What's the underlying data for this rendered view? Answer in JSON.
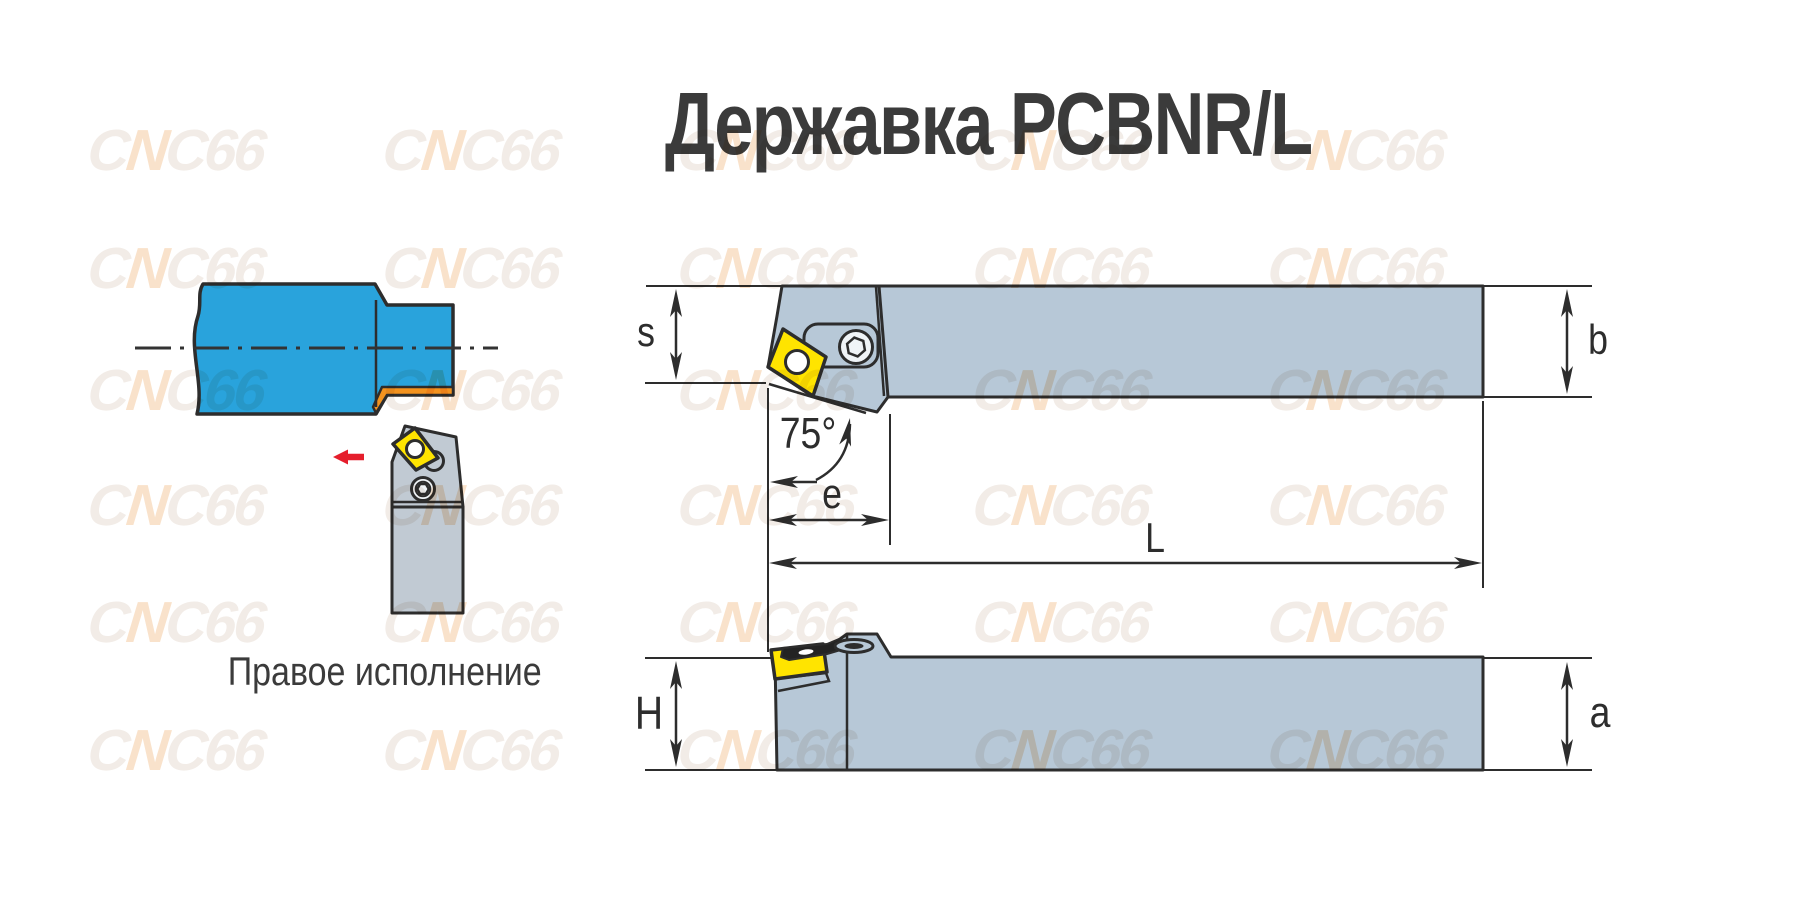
{
  "title": "Державка PCBNR/L",
  "caption": "Правое исполнение",
  "watermark": {
    "text": "CNC66",
    "parts": [
      "C",
      "N",
      "C66"
    ]
  },
  "dimensions": {
    "s": "s",
    "b": "b",
    "angle": "75°",
    "e": "e",
    "L": "L",
    "H": "H",
    "a": "a"
  },
  "colors": {
    "workpiece_blue": "#29a3dc",
    "machined_orange": "#f3931f",
    "insert_yellow": "#ffe400",
    "holder_gray": "#b7c8d7",
    "holder_gray_left": "#c1cad3",
    "screw_face": "#f0f4f7",
    "line_dark": "#2d2d2d",
    "feed_arrow_red": "#e51e2c",
    "text_dark": "#3b3b3b",
    "watermark_gray": "#f2ece7",
    "watermark_orange": "#f9e2cb"
  }
}
